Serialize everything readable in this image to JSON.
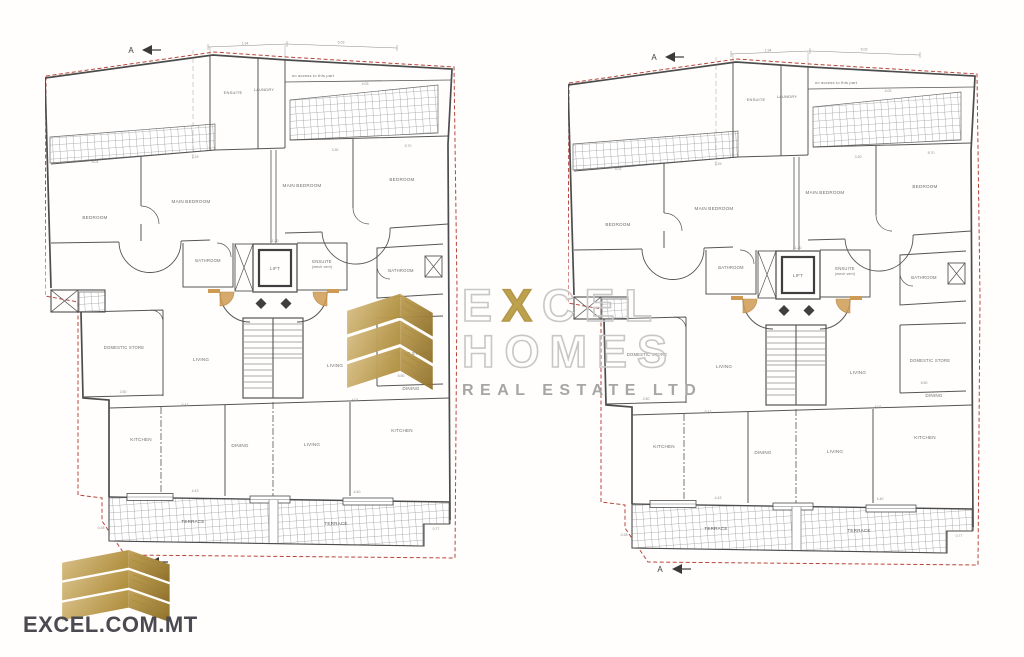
{
  "branding": {
    "watermark": {
      "e": "E",
      "x": "X",
      "cel": "CEL",
      "homes": "HOMES",
      "tagline": "REAL ESTATE LTD"
    },
    "website": "EXCEL.COM.MT",
    "colors": {
      "gold": "#bfa14f",
      "gold_dark": "#8e702a",
      "outline_gray": "#c7c7c7",
      "tagline_gray": "#a6a6a6",
      "website_gray": "#4a4a50"
    }
  },
  "plan": {
    "section_marker": "A",
    "rooms": {
      "bedroom": "BEDROOM",
      "main_bedroom": "MAIN BEDROOM",
      "ensuite_top": "ENSUITE",
      "laundry": "LAUNDRY",
      "no_access": "no access to this part",
      "bathroom": "BATHROOM",
      "lift": "LIFT",
      "ensuite": "ENSUITE",
      "ensuite_note": "(mech vent)",
      "domestic_store": "DOMESTIC STORE",
      "living": "LIVING",
      "dining": "DINING",
      "kitchen": "KITCHEN",
      "terrace": "TERRACE"
    },
    "dims": {
      "t1": "1.94",
      "t2": "5.03",
      "t3": "4.03",
      "b1": "5.01",
      "b2": "1.29",
      "b3": "3.30",
      "b4": "5.70",
      "lift": "1.20",
      "st": "2.50",
      "st2": "5.50",
      "m1": "5.43",
      "m2": "4.01",
      "k1": "4.43",
      "k2": "4.40",
      "bl": "0.28",
      "br": "0.77"
    },
    "colors": {
      "wall": "#4c4c4c",
      "boundary_red": "#b8453b",
      "door_orange": "#cf9a52",
      "tile_line": "#9a9a9a",
      "label_gray": "#6d6d6d"
    }
  }
}
